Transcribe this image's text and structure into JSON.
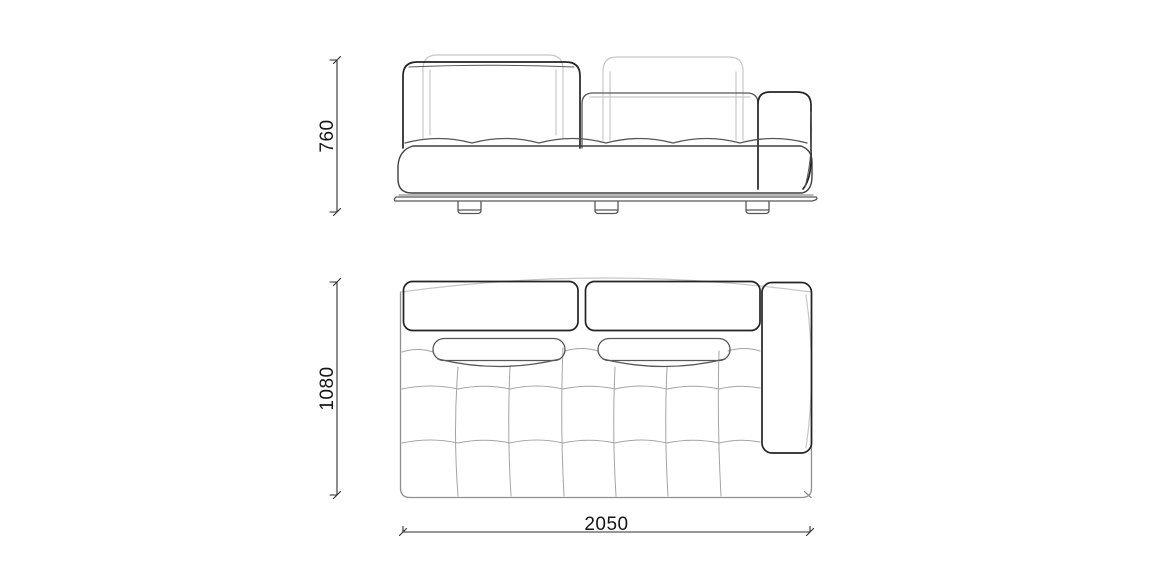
{
  "drawing": {
    "dimensions": {
      "height": "760",
      "depth": "1080",
      "width": "2050"
    },
    "colors": {
      "line_dark": "#232323",
      "line_medium": "#575757",
      "line_body": "#8f8f8f",
      "line_light": "#c7c7c7",
      "line_grid": "#a4a4a4",
      "dimension_line": "#2e2e2e",
      "dimension_text": "#151515",
      "background": "#ffffff"
    }
  }
}
